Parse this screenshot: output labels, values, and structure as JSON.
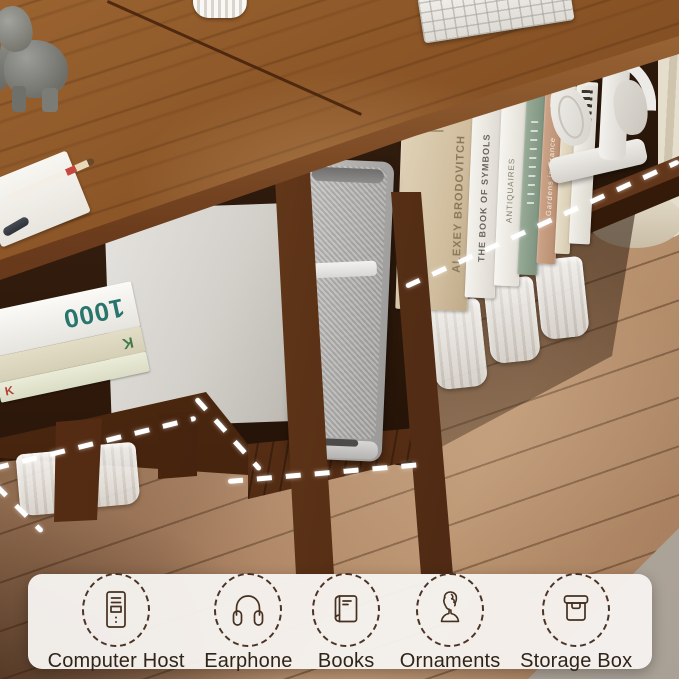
{
  "colors": {
    "desk_wood": "#8a5426",
    "desk_edge": "#5d3315",
    "floor_wood": "#ad8767",
    "under_desk_shadow": "#2a160a",
    "curtain": "#ded5c2",
    "carpet": "#b4aba1",
    "banner_background": "#f4f1ec",
    "icon_stroke": "#46301f",
    "label_text": "#2f2418",
    "dash_line": "#ffffff",
    "pc_tower_silver": "#b0afad"
  },
  "scene": {
    "left_book_stack": {
      "spine_top": "1000",
      "spine_mid": "K",
      "spine_bottom": "K"
    },
    "right_books": {
      "book1": "ALEXEY BRODOVITCH",
      "book2": "THE BOOK OF SYMBOLS",
      "book3": "ANTIQUAIRES",
      "book5": "Gardens in France"
    }
  },
  "legend": {
    "items": [
      {
        "label": "Computer Host",
        "icon": "computer-tower-icon"
      },
      {
        "label": "Earphone",
        "icon": "headphones-icon"
      },
      {
        "label": "Books",
        "icon": "book-icon"
      },
      {
        "label": "Ornaments",
        "icon": "bust-statue-icon"
      },
      {
        "label": "Storage Box",
        "icon": "storage-box-icon"
      }
    ]
  }
}
